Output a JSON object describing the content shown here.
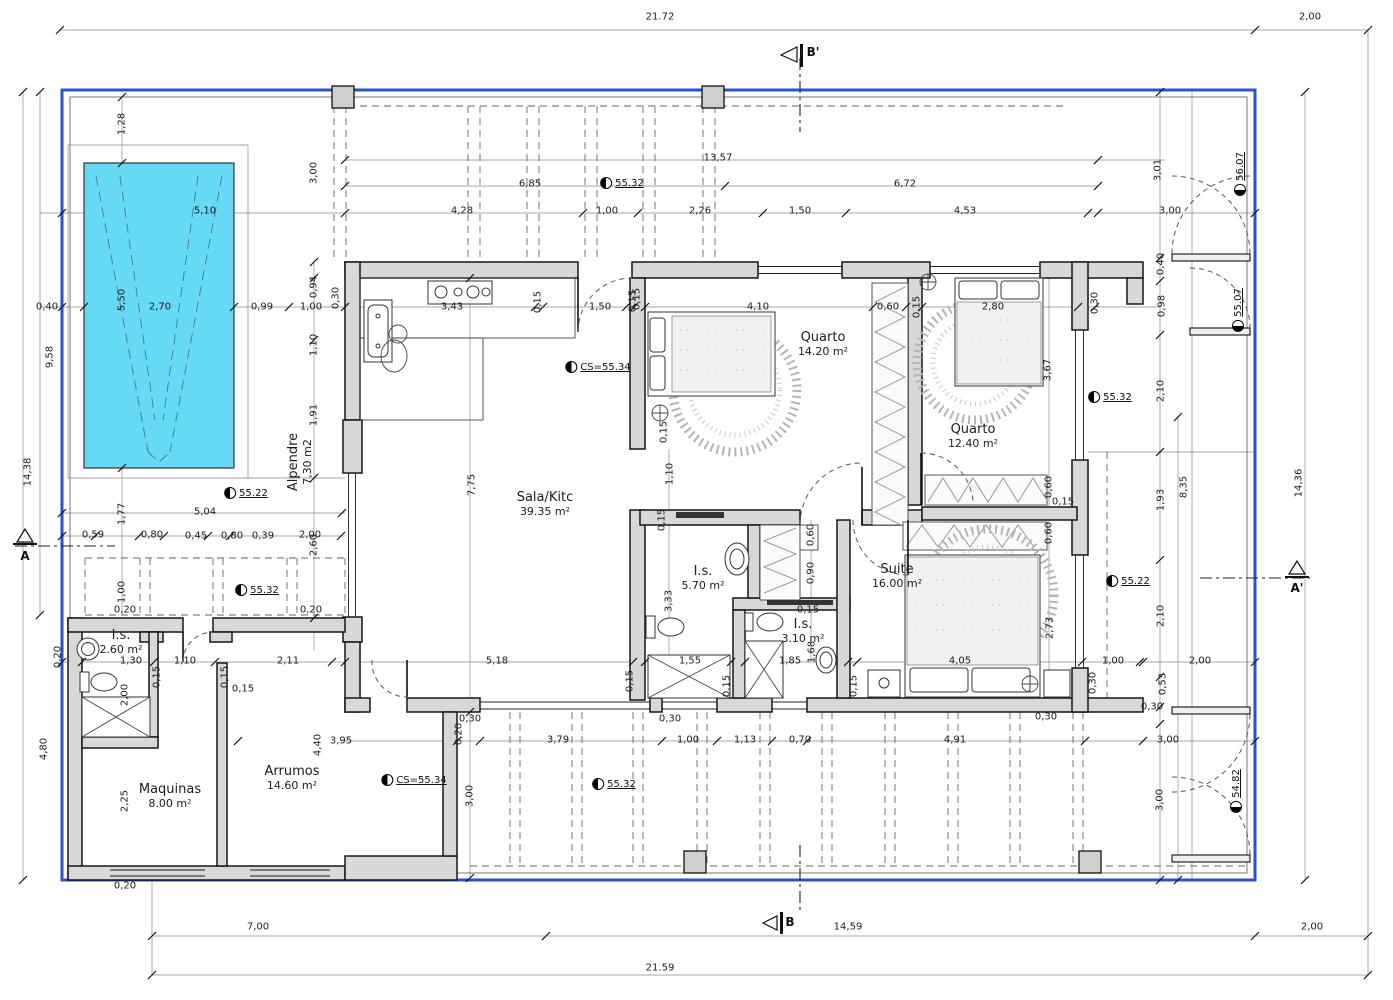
{
  "colors": {
    "boundary": "#2b52cb",
    "pool_fill": "#66d9f5",
    "wall_fill": "#d8d8d8"
  },
  "section_markers": {
    "top": "B'",
    "bottom": "B",
    "left": "A",
    "right": "A'"
  },
  "rooms": [
    {
      "name": "Sala/Kitc",
      "area": "39.35 m²",
      "x": 545,
      "y": 505
    },
    {
      "name": "Quarto",
      "area": "14.20 m²",
      "x": 823,
      "y": 345
    },
    {
      "name": "Quarto",
      "area": "12.40 m²",
      "x": 973,
      "y": 437
    },
    {
      "name": "Suite",
      "area": "16.00 m²",
      "x": 897,
      "y": 577
    },
    {
      "name": "I.s.",
      "area": "5.70 m²",
      "x": 703,
      "y": 579
    },
    {
      "name": "I.s.",
      "area": "3.10 m²",
      "x": 803,
      "y": 632
    },
    {
      "name": "I.s.",
      "area": "2.60 m²",
      "x": 121,
      "y": 643
    },
    {
      "name": "Maquinas",
      "area": "8.00 m²",
      "x": 170,
      "y": 797
    },
    {
      "name": "Arrumos",
      "area": "14.60 m²",
      "x": 292,
      "y": 779
    },
    {
      "name": "Alpendre",
      "area": "7,30 m2",
      "x": 301,
      "y": 462,
      "r": -90
    }
  ],
  "level_markers": [
    {
      "t": "55.32",
      "x": 622,
      "y": 183
    },
    {
      "t": "55.32",
      "x": 1110,
      "y": 397
    },
    {
      "t": "55.32",
      "x": 257,
      "y": 590
    },
    {
      "t": "55.32",
      "x": 614,
      "y": 784
    },
    {
      "t": "55.22",
      "x": 246,
      "y": 493
    },
    {
      "t": "55.22",
      "x": 1128,
      "y": 581
    },
    {
      "t": "CS=55.34",
      "x": 598,
      "y": 367
    },
    {
      "t": "CS=55.34",
      "x": 414,
      "y": 780
    },
    {
      "t": "56.07",
      "x": 1240,
      "y": 174,
      "r": -90
    },
    {
      "t": "55.07",
      "x": 1238,
      "y": 310,
      "r": -90
    },
    {
      "t": "54.82",
      "x": 1236,
      "y": 791,
      "r": -90
    }
  ],
  "dim_labels": [
    {
      "t": "21.72",
      "x": 660,
      "y": 17
    },
    {
      "t": "2,00",
      "x": 1310,
      "y": 17
    },
    {
      "t": "13,57",
      "x": 718,
      "y": 158
    },
    {
      "t": "6,85",
      "x": 530,
      "y": 184
    },
    {
      "t": "6,72",
      "x": 905,
      "y": 184
    },
    {
      "t": "5,10",
      "x": 205,
      "y": 211
    },
    {
      "t": "4,28",
      "x": 462,
      "y": 211
    },
    {
      "t": "1,00",
      "x": 607,
      "y": 211
    },
    {
      "t": "2,26",
      "x": 700,
      "y": 211
    },
    {
      "t": "1,50",
      "x": 800,
      "y": 211
    },
    {
      "t": "4,53",
      "x": 965,
      "y": 211
    },
    {
      "t": "3,00",
      "x": 1170,
      "y": 211
    },
    {
      "t": "1,28",
      "x": 122,
      "y": 124,
      "r": -90
    },
    {
      "t": "3,00",
      "x": 314,
      "y": 173,
      "r": -90
    },
    {
      "t": "3,01",
      "x": 1158,
      "y": 170,
      "r": -90
    },
    {
      "t": "0,40",
      "x": 47,
      "y": 307
    },
    {
      "t": "2,70",
      "x": 160,
      "y": 307
    },
    {
      "t": "0,99",
      "x": 262,
      "y": 307
    },
    {
      "t": "1,00",
      "x": 311,
      "y": 307
    },
    {
      "t": "5,50",
      "x": 122,
      "y": 300,
      "r": -90
    },
    {
      "t": "3,43",
      "x": 452,
      "y": 307
    },
    {
      "t": "0,15",
      "x": 538,
      "y": 302,
      "r": -90
    },
    {
      "t": "1,50",
      "x": 600,
      "y": 307
    },
    {
      "t": "0,15",
      "x": 633,
      "y": 301,
      "r": -90
    },
    {
      "t": "4,10",
      "x": 758,
      "y": 307
    },
    {
      "t": "0,60",
      "x": 888,
      "y": 307
    },
    {
      "t": "0,15",
      "x": 917,
      "y": 307,
      "r": -90
    },
    {
      "t": "2,80",
      "x": 993,
      "y": 307
    },
    {
      "t": "0,30",
      "x": 1095,
      "y": 303,
      "r": -90
    },
    {
      "t": "0,40",
      "x": 1161,
      "y": 264,
      "r": -90
    },
    {
      "t": "0,98",
      "x": 1162,
      "y": 306,
      "r": -90
    },
    {
      "t": "0,94",
      "x": 314,
      "y": 287,
      "r": -90
    },
    {
      "t": "0,30",
      "x": 336,
      "y": 298,
      "r": -90
    },
    {
      "t": "1,10",
      "x": 314,
      "y": 345,
      "r": -90
    },
    {
      "t": "1,91",
      "x": 314,
      "y": 415,
      "r": -90
    },
    {
      "t": "2,60",
      "x": 314,
      "y": 545,
      "r": -90
    },
    {
      "t": "9,58",
      "x": 50,
      "y": 357,
      "r": -90
    },
    {
      "t": "14,38",
      "x": 28,
      "y": 472,
      "r": -90
    },
    {
      "t": "7,75",
      "x": 472,
      "y": 485,
      "r": -90
    },
    {
      "t": "0,15",
      "x": 637,
      "y": 299,
      "r": -90
    },
    {
      "t": "0,15",
      "x": 664,
      "y": 432,
      "r": -90
    },
    {
      "t": "1,10",
      "x": 670,
      "y": 474,
      "r": -90
    },
    {
      "t": "3,67",
      "x": 1048,
      "y": 370,
      "r": -90
    },
    {
      "t": "2,10",
      "x": 1161,
      "y": 391,
      "r": -90
    },
    {
      "t": "1,93",
      "x": 1161,
      "y": 500,
      "r": -90
    },
    {
      "t": "8,35",
      "x": 1184,
      "y": 487,
      "r": -90
    },
    {
      "t": "14,36",
      "x": 1299,
      "y": 483,
      "r": -90
    },
    {
      "t": "2,10",
      "x": 1161,
      "y": 616,
      "r": -90
    },
    {
      "t": "1,77",
      "x": 122,
      "y": 514,
      "r": -90
    },
    {
      "t": "5,04",
      "x": 205,
      "y": 512
    },
    {
      "t": "0,59",
      "x": 93,
      "y": 535
    },
    {
      "t": "0,80",
      "x": 152,
      "y": 535
    },
    {
      "t": "0,45",
      "x": 196,
      "y": 536
    },
    {
      "t": "0,80",
      "x": 232,
      "y": 536
    },
    {
      "t": "0,39",
      "x": 263,
      "y": 536
    },
    {
      "t": "2,00",
      "x": 310,
      "y": 535
    },
    {
      "t": "1,00",
      "x": 122,
      "y": 592,
      "r": -90
    },
    {
      "t": "0,20",
      "x": 125,
      "y": 610
    },
    {
      "t": "0,20",
      "x": 311,
      "y": 610
    },
    {
      "t": "0,20",
      "x": 58,
      "y": 657,
      "r": -90
    },
    {
      "t": "0,60",
      "x": 1049,
      "y": 487,
      "r": -90
    },
    {
      "t": "0,15",
      "x": 1063,
      "y": 502
    },
    {
      "t": "0,60",
      "x": 1049,
      "y": 533,
      "r": -90
    },
    {
      "t": "0,15",
      "x": 662,
      "y": 520,
      "r": -90
    },
    {
      "t": "0,60",
      "x": 811,
      "y": 535,
      "r": -90
    },
    {
      "t": "0,90",
      "x": 811,
      "y": 573,
      "r": -90
    },
    {
      "t": "0,15",
      "x": 808,
      "y": 610
    },
    {
      "t": "3,33",
      "x": 669,
      "y": 601,
      "r": -90
    },
    {
      "t": "1,68",
      "x": 812,
      "y": 652,
      "r": -90
    },
    {
      "t": "1,30",
      "x": 131,
      "y": 661
    },
    {
      "t": "1,10",
      "x": 185,
      "y": 661
    },
    {
      "t": "2,11",
      "x": 288,
      "y": 661
    },
    {
      "t": "5,18",
      "x": 497,
      "y": 661
    },
    {
      "t": "1,55",
      "x": 690,
      "y": 661
    },
    {
      "t": "1,85",
      "x": 790,
      "y": 661
    },
    {
      "t": "4,05",
      "x": 960,
      "y": 661
    },
    {
      "t": "1,00",
      "x": 1113,
      "y": 661
    },
    {
      "t": "2,00",
      "x": 1200,
      "y": 661
    },
    {
      "t": "2,73",
      "x": 1050,
      "y": 628,
      "r": -90
    },
    {
      "t": "0,15",
      "x": 157,
      "y": 677,
      "r": -90
    },
    {
      "t": "0,15",
      "x": 225,
      "y": 677,
      "r": -90
    },
    {
      "t": "0,15",
      "x": 630,
      "y": 681,
      "r": -90
    },
    {
      "t": "0,15",
      "x": 727,
      "y": 686,
      "r": -90
    },
    {
      "t": "0,15",
      "x": 854,
      "y": 686,
      "r": -90
    },
    {
      "t": "0,30",
      "x": 1093,
      "y": 683,
      "r": -90
    },
    {
      "t": "0,53",
      "x": 1163,
      "y": 684,
      "r": -90
    },
    {
      "t": "2,00",
      "x": 125,
      "y": 695,
      "r": -90
    },
    {
      "t": "4,80",
      "x": 44,
      "y": 749,
      "r": -90
    },
    {
      "t": "0,15",
      "x": 243,
      "y": 689
    },
    {
      "t": "2,25",
      "x": 125,
      "y": 801,
      "r": -90
    },
    {
      "t": "4,40",
      "x": 318,
      "y": 745,
      "r": -90
    },
    {
      "t": "3,95",
      "x": 341,
      "y": 741
    },
    {
      "t": "0,20",
      "x": 459,
      "y": 734,
      "r": -90
    },
    {
      "t": "0,30",
      "x": 470,
      "y": 719
    },
    {
      "t": "0,30",
      "x": 670,
      "y": 719
    },
    {
      "t": "3,79",
      "x": 558,
      "y": 740
    },
    {
      "t": "1,00",
      "x": 688,
      "y": 740
    },
    {
      "t": "1,13",
      "x": 745,
      "y": 740
    },
    {
      "t": "0,70",
      "x": 800,
      "y": 740
    },
    {
      "t": "4,91",
      "x": 955,
      "y": 740
    },
    {
      "t": "0,30",
      "x": 1046,
      "y": 717
    },
    {
      "t": "0,30",
      "x": 1152,
      "y": 707
    },
    {
      "t": "3,00",
      "x": 1168,
      "y": 740
    },
    {
      "t": "3,00",
      "x": 470,
      "y": 796,
      "r": -90
    },
    {
      "t": "3,00",
      "x": 1160,
      "y": 800,
      "r": -90
    },
    {
      "t": "0,20",
      "x": 125,
      "y": 886
    },
    {
      "t": "7,00",
      "x": 258,
      "y": 927
    },
    {
      "t": "14,59",
      "x": 848,
      "y": 927
    },
    {
      "t": "2,00",
      "x": 1312,
      "y": 927
    },
    {
      "t": "21.59",
      "x": 660,
      "y": 968
    }
  ]
}
